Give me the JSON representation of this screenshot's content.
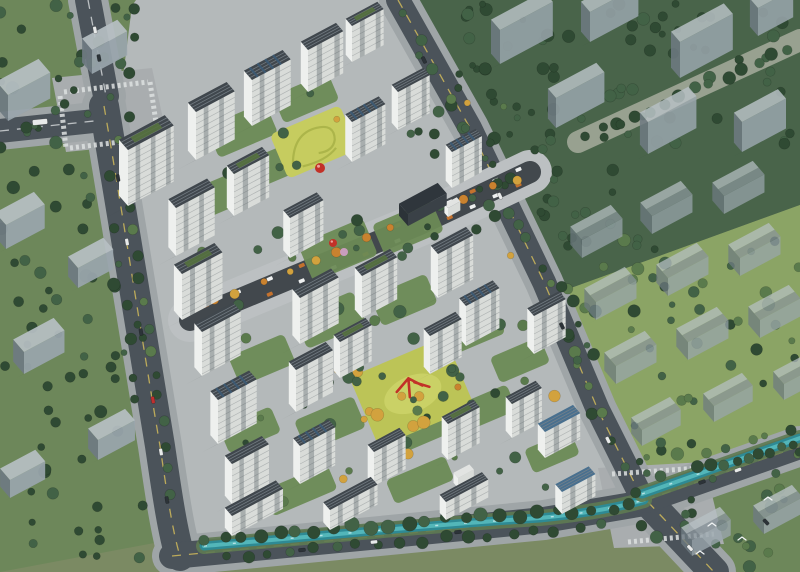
{
  "meta": {
    "title": "Aerial bird's-eye rendering of a residential master plan with white apartment towers, landscaped courtyards, commercial street, canal and surrounding massing buildings",
    "render_type": "architectural-visualization",
    "viewport": "800x572"
  },
  "palette": {
    "base": "#7b8a63",
    "greenDark": "#49644a",
    "greenMid": "#6d875a",
    "greenBright": "#8ba465",
    "treeDark": "#2f4a33",
    "treeMid": "#426246",
    "treeLight": "#5a7a4c",
    "treeAutumn": "#d2a23e",
    "treeOrange": "#c9822f",
    "treeBlossom": "#cf9ec4",
    "asphalt": "#4b535a",
    "sidewalk": "#9fa5a7",
    "plaza": "#a9adaf",
    "paving": "#b4b9ba",
    "promenade": "#98a190",
    "roadLineY": "#d8c05a",
    "roadLineW": "#d8dcdd",
    "ctxWall": "#9aa6ad",
    "ctxWallShade": "#6f7b83",
    "ctxRoofLight": "#b7c0c4",
    "ctxRoofDark": "#8b969d",
    "darkWall": "#3a4147",
    "darkRoof": "#2f363c",
    "towerFace": "#d9dcd9",
    "towerSide": "#eef0ee",
    "winBand": "rgba(90,100,105,0.38)",
    "floorLine": "rgba(55,65,70,0.25)",
    "roofDark": "#40474d",
    "roofRib": "#79828a",
    "roofBlue": "#49708f",
    "roofPanel": "#3c5a74",
    "roofGreen": "#55713f",
    "shadow": "rgba(25,35,30,0.30)",
    "water": "#2e8a94",
    "waterLight": "#5cc0c2",
    "waterGlint": "#cfeff0",
    "lawnYellow": "#c6cc5f",
    "lawnYellow2": "#bcc457",
    "lawnYellowDark": "#a9b348",
    "streetDark": "#42484d",
    "shopOrange": "#c4722e",
    "red": "#c23128",
    "carDark": "#2c3338",
    "carWhite": "#e8eaea",
    "carRed": "#c03030",
    "white": "#eef0f0"
  },
  "scene": {
    "ground_regions": [
      {
        "name": "context-greens-topright",
        "fill": "greenDark",
        "pts": [
          [
            400,
            0
          ],
          [
            800,
            0
          ],
          [
            800,
            205
          ],
          [
            560,
            292
          ],
          [
            470,
            122
          ]
        ]
      },
      {
        "name": "context-field-right",
        "fill": "greenBright",
        "pts": [
          [
            560,
            292
          ],
          [
            800,
            205
          ],
          [
            800,
            442
          ],
          [
            644,
            482
          ],
          [
            592,
            402
          ]
        ]
      },
      {
        "name": "context-greens-bottomright",
        "fill": "greenMid",
        "pts": [
          [
            644,
            482
          ],
          [
            800,
            442
          ],
          [
            800,
            572
          ],
          [
            700,
            572
          ]
        ]
      },
      {
        "name": "context-greens-left",
        "fill": "greenMid",
        "pts": [
          [
            0,
            0
          ],
          [
            138,
            0
          ],
          [
            170,
            540
          ],
          [
            0,
            572
          ]
        ]
      },
      {
        "name": "compound-paving",
        "fill": "paving",
        "pts": [
          [
            118,
            116
          ],
          [
            132,
            6
          ],
          [
            136,
            0
          ],
          [
            394,
            0
          ],
          [
            420,
            40
          ],
          [
            470,
            128
          ],
          [
            544,
            282
          ],
          [
            596,
            410
          ],
          [
            636,
            494
          ],
          [
            560,
            516
          ],
          [
            470,
            514
          ],
          [
            380,
            528
          ],
          [
            290,
            538
          ],
          [
            208,
            546
          ],
          [
            186,
            522
          ],
          [
            168,
            470
          ],
          [
            150,
            372
          ],
          [
            130,
            244
          ]
        ]
      },
      {
        "name": "intersection-plaza-nw",
        "fill": "plaza",
        "pts": [
          [
            52,
            78
          ],
          [
            152,
            68
          ],
          [
            168,
            142
          ],
          [
            66,
            152
          ]
        ]
      },
      {
        "name": "intersection-plaza-se",
        "fill": "plaza",
        "pts": [
          [
            598,
            468
          ],
          [
            704,
            462
          ],
          [
            724,
            544
          ],
          [
            614,
            548
          ]
        ]
      }
    ],
    "roads": [
      {
        "name": "north-road",
        "p": "M88,0 L106,96",
        "w": 26,
        "sw": 1,
        "line": "w"
      },
      {
        "name": "west-road",
        "p": "M0,131 L94,121",
        "w": 24,
        "sw": 1,
        "line": "w"
      },
      {
        "name": "west-boundary-road",
        "p": "M104,106 C122,210 142,340 160,446 C166,486 172,530 180,556",
        "w": 30,
        "sw": 1,
        "line": "y"
      },
      {
        "name": "south-boundary-road",
        "p": "M172,556 L380,536 L544,520 L650,502",
        "w": 26,
        "sw": 1,
        "line": "y"
      },
      {
        "name": "east-boundary-road",
        "p": "M398,0 L470,128 L544,282 L598,410 L642,498",
        "w": 24,
        "sw": 1,
        "line": "y"
      },
      {
        "name": "southeast-road",
        "p": "M648,502 L714,572",
        "w": 30,
        "sw": 1,
        "line": "y"
      },
      {
        "name": "northeast-road",
        "p": "M646,500 L800,446",
        "w": 26,
        "sw": 1,
        "line": "y"
      },
      {
        "name": "promenade",
        "p": "M800,40 L578,142",
        "w": 22,
        "sw": 0,
        "color": "promenade"
      }
    ],
    "canal": {
      "name": "canal",
      "segments": [
        "M204,546 C320,536 440,524 540,518 C580,514 616,508 644,500",
        "M642,494 L800,438"
      ]
    },
    "street": {
      "name": "commercial-street",
      "p": "M190,320 L420,224 L530,172",
      "pts": [
        [
          190,
          320
        ],
        [
          420,
          224
        ],
        [
          530,
          172
        ]
      ],
      "shops": 12
    },
    "courtyards": [
      [
        242,
        130,
        64,
        34
      ],
      [
        306,
        98,
        60,
        30
      ],
      [
        218,
        196,
        60,
        32
      ],
      [
        282,
        162,
        56,
        30
      ],
      [
        338,
        250,
        70,
        40
      ],
      [
        408,
        228,
        64,
        34
      ],
      [
        330,
        320,
        64,
        36
      ],
      [
        404,
        300,
        60,
        32
      ],
      [
        474,
        330,
        56,
        30
      ],
      [
        262,
        360,
        60,
        32
      ],
      [
        330,
        424,
        64,
        34
      ],
      [
        414,
        432,
        60,
        30
      ],
      [
        486,
        408,
        56,
        28
      ],
      [
        250,
        430,
        56,
        28
      ],
      [
        300,
        490,
        70,
        28
      ],
      [
        420,
        480,
        64,
        26
      ],
      [
        520,
        360,
        54,
        28
      ],
      [
        552,
        452,
        50,
        26
      ]
    ],
    "lawns": {
      "north_lawn": {
        "cx": 314,
        "cy": 142,
        "w": 76,
        "h": 48
      },
      "south_lawn": {
        "cx": 412,
        "cy": 392,
        "w": 104,
        "h": 76
      }
    },
    "towers": [
      [
        128,
        150,
        52,
        20,
        56,
        "g"
      ],
      [
        196,
        112,
        44,
        18,
        48,
        "r"
      ],
      [
        252,
        80,
        44,
        18,
        46,
        "p"
      ],
      [
        308,
        50,
        40,
        16,
        42,
        "r"
      ],
      [
        352,
        26,
        36,
        14,
        36,
        "g"
      ],
      [
        398,
        92,
        36,
        14,
        38,
        "r"
      ],
      [
        452,
        152,
        34,
        14,
        36,
        "p"
      ],
      [
        176,
        208,
        44,
        17,
        48,
        "r"
      ],
      [
        234,
        174,
        40,
        16,
        42,
        "g"
      ],
      [
        290,
        218,
        38,
        15,
        40,
        "r"
      ],
      [
        352,
        122,
        38,
        15,
        40,
        "p"
      ],
      [
        300,
        298,
        44,
        17,
        46,
        "r"
      ],
      [
        362,
        276,
        40,
        16,
        42,
        "g"
      ],
      [
        438,
        254,
        40,
        16,
        44,
        "r"
      ],
      [
        466,
        306,
        38,
        15,
        40,
        "p"
      ],
      [
        534,
        316,
        36,
        15,
        38,
        "r"
      ],
      [
        182,
        274,
        46,
        18,
        46,
        "g"
      ],
      [
        202,
        332,
        44,
        17,
        44,
        "r"
      ],
      [
        218,
        400,
        44,
        17,
        44,
        "p"
      ],
      [
        232,
        464,
        42,
        16,
        40,
        "r"
      ],
      [
        296,
        370,
        42,
        16,
        42,
        "r"
      ],
      [
        340,
        342,
        36,
        14,
        36,
        "g"
      ],
      [
        430,
        336,
        36,
        14,
        38,
        "r"
      ],
      [
        300,
        446,
        40,
        15,
        38,
        "p"
      ],
      [
        374,
        452,
        36,
        14,
        34,
        "r"
      ],
      [
        448,
        424,
        36,
        14,
        36,
        "g"
      ],
      [
        512,
        404,
        34,
        14,
        34,
        "r"
      ],
      [
        545,
        432,
        40,
        16,
        26,
        "b"
      ],
      [
        562,
        492,
        38,
        15,
        22,
        "b"
      ],
      [
        232,
        516,
        58,
        16,
        20,
        "r"
      ],
      [
        330,
        510,
        54,
        15,
        20,
        "r"
      ],
      [
        446,
        502,
        48,
        14,
        18,
        "r"
      ],
      [
        458,
        478,
        18,
        10,
        10,
        "w"
      ],
      [
        448,
        208,
        14,
        8,
        9,
        "w"
      ]
    ],
    "context_buildings": [
      [
        8,
        95,
        48,
        26,
        26,
        0,
        0.92
      ],
      [
        92,
        50,
        40,
        22,
        24,
        0,
        0.92
      ],
      [
        6,
        225,
        44,
        24,
        24,
        0,
        0.92
      ],
      [
        78,
        268,
        40,
        22,
        20,
        0,
        0.92
      ],
      [
        24,
        352,
        46,
        24,
        22,
        0,
        0.92
      ],
      [
        98,
        440,
        42,
        22,
        20,
        0,
        0.92
      ],
      [
        10,
        480,
        40,
        22,
        18,
        0,
        0.92
      ],
      [
        500,
        30,
        60,
        20,
        34,
        0,
        0.85
      ],
      [
        590,
        12,
        55,
        20,
        30,
        0,
        0.85
      ],
      [
        680,
        42,
        60,
        20,
        36,
        0,
        0.85
      ],
      [
        758,
        8,
        40,
        18,
        28,
        0,
        0.85
      ],
      [
        556,
        98,
        55,
        18,
        30,
        0,
        0.85
      ],
      [
        648,
        122,
        55,
        18,
        32,
        0,
        0.85
      ],
      [
        742,
        122,
        50,
        18,
        30,
        0,
        0.85
      ],
      [
        582,
        240,
        46,
        26,
        18,
        1,
        0.72
      ],
      [
        652,
        216,
        46,
        26,
        18,
        1,
        0.72
      ],
      [
        724,
        196,
        46,
        26,
        18,
        1,
        0.72
      ],
      [
        596,
        302,
        46,
        26,
        18,
        1,
        0.72
      ],
      [
        668,
        278,
        46,
        26,
        18,
        1,
        0.72
      ],
      [
        740,
        258,
        46,
        26,
        18,
        1,
        0.72
      ],
      [
        616,
        366,
        46,
        26,
        18,
        1,
        0.72
      ],
      [
        688,
        342,
        46,
        26,
        18,
        1,
        0.72
      ],
      [
        760,
        320,
        46,
        26,
        18,
        1,
        0.72
      ],
      [
        642,
        430,
        44,
        24,
        16,
        1,
        0.72
      ],
      [
        714,
        406,
        44,
        24,
        16,
        1,
        0.72
      ],
      [
        784,
        384,
        44,
        24,
        16,
        1,
        0.72
      ],
      [
        692,
        540,
        44,
        24,
        16,
        1,
        0.8
      ],
      [
        764,
        518,
        44,
        24,
        16,
        1,
        0.8
      ],
      [
        408,
        214,
        44,
        20,
        12,
        0,
        1,
        "dark"
      ]
    ],
    "tree_regions": [
      [
        0,
        0,
        140,
        118,
        26,
        "dk"
      ],
      [
        0,
        118,
        128,
        200,
        32,
        "dk"
      ],
      [
        0,
        318,
        148,
        250,
        40,
        "dk"
      ],
      [
        408,
        0,
        392,
        148,
        80,
        "dk"
      ],
      [
        470,
        128,
        145,
        118,
        26,
        "dk"
      ],
      [
        558,
        238,
        242,
        200,
        52,
        "md"
      ],
      [
        628,
        438,
        172,
        132,
        34,
        "md"
      ],
      [
        188,
        88,
        380,
        185,
        38,
        "cp"
      ],
      [
        228,
        298,
        330,
        205,
        42,
        "cp"
      ],
      [
        348,
        342,
        140,
        100,
        14,
        "au"
      ]
    ],
    "tree_rows": [
      [
        205,
        538,
        630,
        506,
        24,
        6,
        "dk"
      ],
      [
        225,
        556,
        600,
        526,
        18,
        5,
        "dk"
      ],
      [
        700,
        468,
        795,
        446,
        9,
        5,
        "dk"
      ],
      [
        120,
        138,
        172,
        492,
        16,
        4.5,
        "md"
      ],
      [
        404,
        12,
        540,
        268,
        10,
        4.5,
        "md"
      ],
      [
        548,
        286,
        634,
        490,
        9,
        4.5,
        "md"
      ],
      [
        588,
        136,
        788,
        50,
        14,
        5,
        "dk"
      ],
      [
        212,
        302,
        516,
        178,
        13,
        4,
        "au"
      ]
    ],
    "blossom_trees": [
      [
        362,
        148
      ],
      [
        306,
        206
      ],
      [
        344,
        252
      ]
    ],
    "spheres": [
      [
        320,
        168,
        5
      ],
      [
        333,
        243,
        4
      ]
    ],
    "cars": [
      [
        118,
        178,
        "d",
        80
      ],
      [
        127,
        242,
        "w",
        80
      ],
      [
        141,
        332,
        "d",
        80
      ],
      [
        153,
        400,
        "r",
        80
      ],
      [
        161,
        452,
        "w",
        80
      ],
      [
        167,
        500,
        "d",
        80
      ],
      [
        95,
        30,
        "w",
        79
      ],
      [
        99,
        58,
        "d",
        79
      ],
      [
        40,
        122,
        "bus",
        -6
      ],
      [
        302,
        550,
        "d",
        -6
      ],
      [
        374,
        542,
        "w",
        -6
      ],
      [
        458,
        532,
        "d",
        -6
      ],
      [
        424,
        60,
        "d",
        64
      ],
      [
        500,
        196,
        "w",
        64
      ],
      [
        562,
        326,
        "d",
        64
      ],
      [
        608,
        440,
        "w",
        64
      ],
      [
        702,
        482,
        "d",
        -20
      ],
      [
        738,
        470,
        "w",
        -20
      ],
      [
        766,
        522,
        "d",
        47
      ],
      [
        690,
        548,
        "w",
        47
      ]
    ],
    "birds": [
      [
        712,
        526
      ],
      [
        742,
        540
      ],
      [
        700,
        554
      ],
      [
        768,
        500
      ]
    ],
    "crosswalks": [
      "M64,92 L148,82",
      "M70,148 L154,138",
      "M60,96 L66,148",
      "M150,82 L158,136",
      "M612,474 L700,468",
      "M628,542 L714,534"
    ]
  }
}
